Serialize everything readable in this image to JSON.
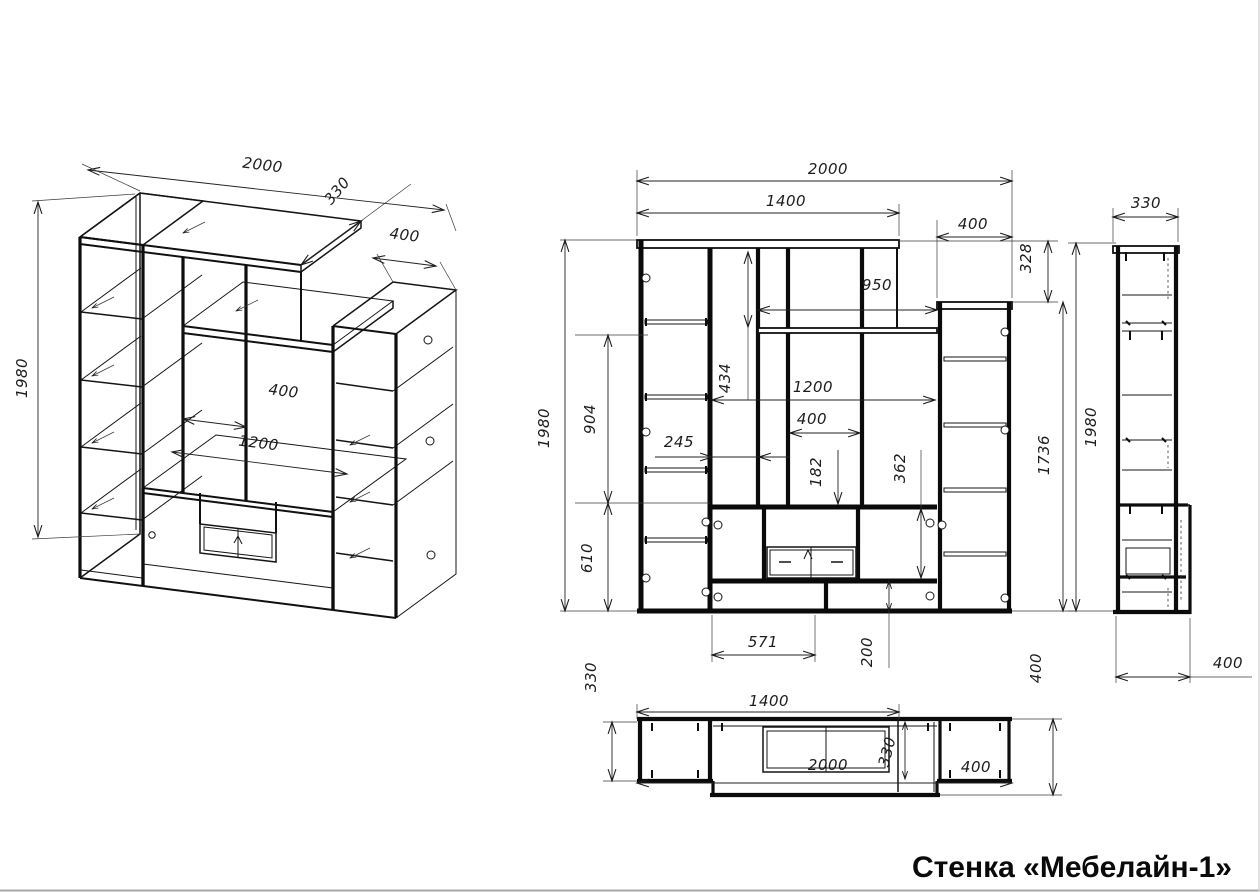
{
  "title": "Стенка «Мебелайн-1»",
  "views": {
    "iso": {
      "dims": {
        "width": "2000",
        "depth": "330",
        "right_width": "400",
        "height": "1980",
        "center_opening": "400",
        "niche_width": "1200"
      }
    },
    "front": {
      "dims": {
        "total_width": "2000",
        "top_panel_width": "1400",
        "right_cab_width": "400",
        "right_top_offset": "328",
        "shelf_width": "950",
        "upper_opening_height": "434",
        "mid_section_height": "904",
        "total_height": "1980",
        "left_opening_width": "245",
        "inner_width": "1200",
        "center_opening_width": "400",
        "tv_top_gap": "182",
        "tv_section_height": "362",
        "bottom_section_height": "610",
        "tv_left_width": "571",
        "plinth_height": "200",
        "right_cab_height": "1736"
      }
    },
    "side": {
      "dims": {
        "depth": "330",
        "height": "1980",
        "bottom_depth": "400"
      }
    },
    "plan": {
      "dims": {
        "depth": "330",
        "top_panel_width": "1400",
        "total_width": "2000",
        "mid_depth": "330",
        "right_cab_width": "400",
        "bottom_depth": "400"
      }
    }
  }
}
